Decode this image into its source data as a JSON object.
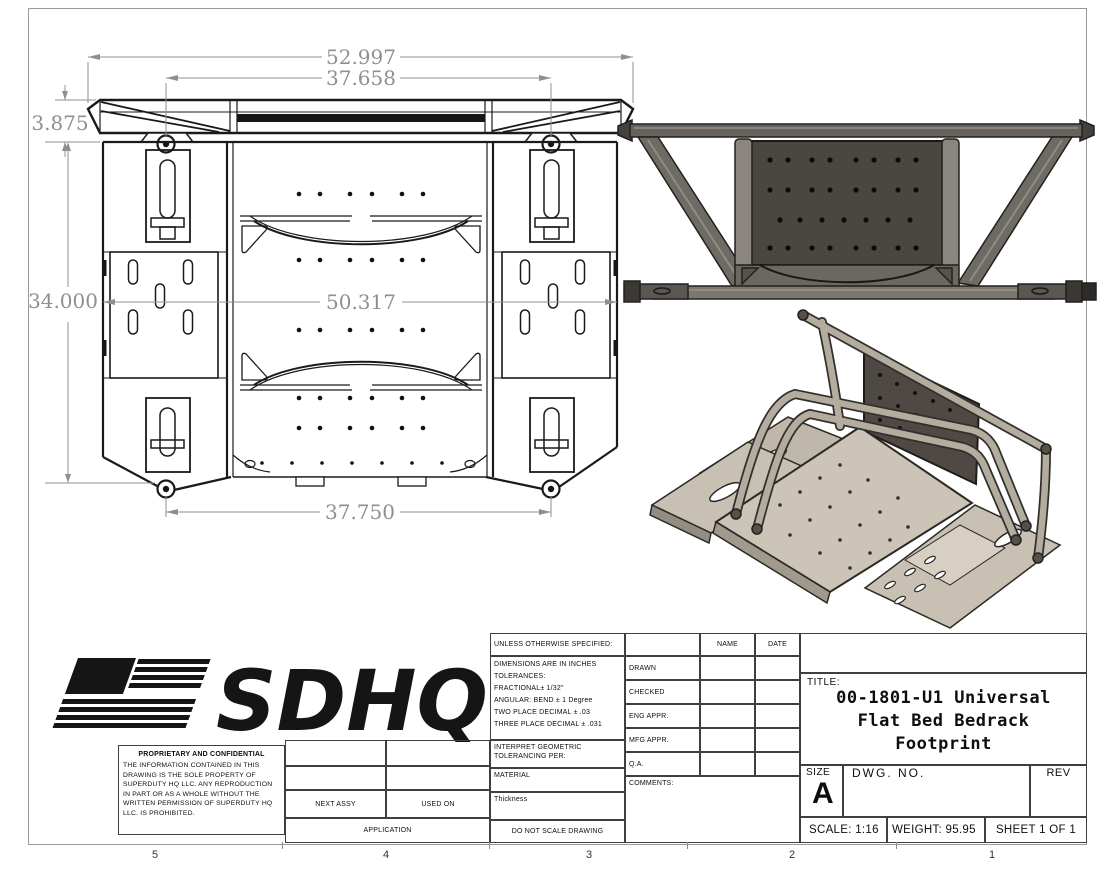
{
  "drawing": {
    "dims": {
      "width_overall": "52.997",
      "width_inner": "37.658",
      "height_bar": "3.875",
      "depth": "34.000",
      "width_mid": "50.317",
      "width_bottom": "37.750"
    }
  },
  "zone_labels": [
    "5",
    "4",
    "3",
    "2",
    "1"
  ],
  "title_block": {
    "logo_text": "SDHQ",
    "proprietary_title": "PROPRIETARY AND CONFIDENTIAL",
    "proprietary_body": "THE INFORMATION CONTAINED IN THIS DRAWING IS THE SOLE PROPERTY OF SUPERDUTY HQ LLC. ANY REPRODUCTION IN PART OR AS A WHOLE WITHOUT THE WRITTEN PERMISSION OF SUPERDUTY HQ LLC. IS PROHIBITED.",
    "next_assy": "NEXT ASSY",
    "used_on": "USED ON",
    "application": "APPLICATION",
    "unless": "UNLESS OTHERWISE SPECIFIED:",
    "tol_lines": [
      "DIMENSIONS ARE IN INCHES",
      "TOLERANCES:",
      "FRACTIONAL± 1/32\"",
      "ANGULAR: BEND ± 1 Degree",
      "TWO PLACE DECIMAL  ± .03",
      "THREE PLACE DECIMAL ± .031"
    ],
    "interpret": "INTERPRET GEOMETRIC TOLERANCING PER:",
    "material": "MATERIAL",
    "thickness": "Thickness",
    "do_not_scale": "DO NOT SCALE DRAWING",
    "name_header": "NAME",
    "date_header": "DATE",
    "approval_rows": [
      "DRAWN",
      "CHECKED",
      "ENG APPR.",
      "MFG APPR.",
      "Q.A."
    ],
    "comments": "COMMENTS:",
    "title_label": "TITLE:",
    "title_lines": [
      "00-1801-U1 Universal",
      "Flat Bed Bedrack",
      "Footprint"
    ],
    "size_label": "SIZE",
    "size_value": "A",
    "dwg_label": "DWG. NO.",
    "rev_label": "REV",
    "scale_text": "SCALE: 1:16",
    "weight_text": "WEIGHT: 95.95",
    "sheet_text": "SHEET 1 OF 1"
  },
  "colors": {
    "linework": "#1a1a1a",
    "dimension_gray": "#8f8f8f",
    "metal_dark_panel": "#4a4642",
    "metal_tube": "#6e6a64",
    "iso_deck_light": "#cbc4b7",
    "iso_tube": "#b4ad9f"
  }
}
